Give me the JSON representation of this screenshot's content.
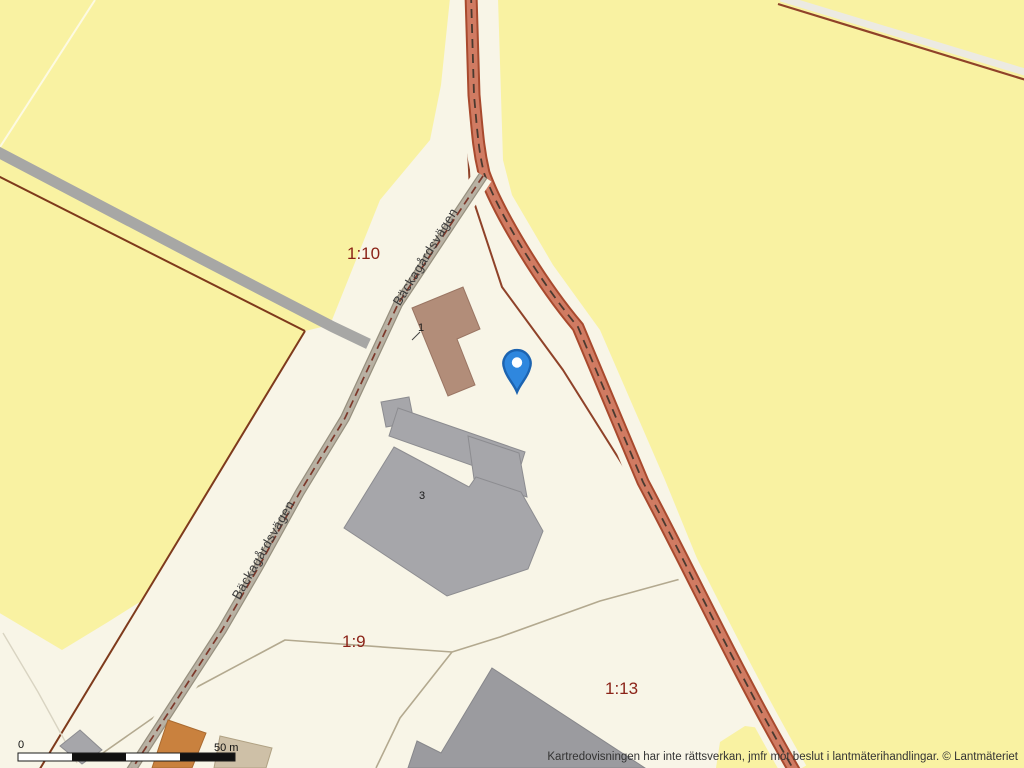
{
  "map_labels": {
    "parcels": [
      {
        "id": "1:10"
      },
      {
        "id": "1:9"
      },
      {
        "id": "1:13"
      }
    ],
    "road_name_top": "Bäckagårdsvägen",
    "road_name_bottom": "Bäckagårdsvägen",
    "building_numbers": {
      "building_1": "1",
      "building_3": "3"
    }
  },
  "marker": {
    "name": "location-pin",
    "fill": "#2f87de",
    "stroke": "#1c63b0"
  },
  "scale_bar": {
    "zero_label": "0",
    "distance_label": "50 m"
  },
  "attribution": {
    "text": "Kartredovisningen har inte rättsverkan, jmfr mot beslut i lantmäterihandlingar. © Lantmäteriet"
  },
  "colors": {
    "field_yellow": "#f9f2a2",
    "background_cream": "#f8f5e7",
    "main_road_fill": "#d07b62",
    "main_road_border": "#a84a2e",
    "local_road_fill": "#b8b1a3",
    "gravel_road_gray": "#a7a7a5",
    "boundary_brown": "#7e3a1c",
    "building_gray": "#a6a6aa",
    "building_brown": "#b28d79",
    "building_orange": "#c9813e",
    "building_beige": "#cec0a7",
    "parcel_label_color": "#8b2318"
  }
}
